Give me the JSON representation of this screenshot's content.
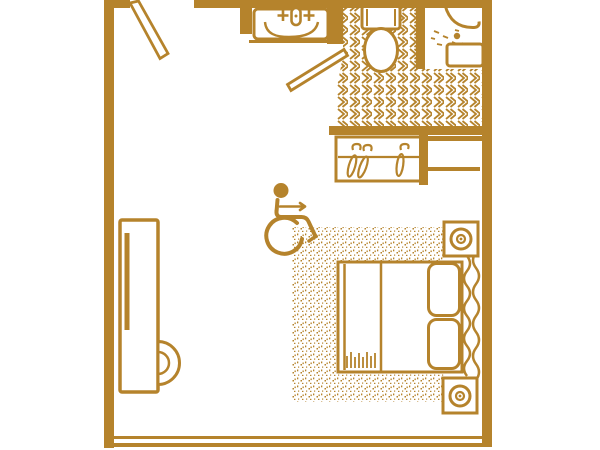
{
  "colors": {
    "ink": "#B5832C",
    "background": "#FFFFFF"
  },
  "floor_plan": {
    "kind": "accessible-hotel-room-floor-plan",
    "tile_pattern": "chevron-tiles",
    "carpet_pattern": "stipple-dots",
    "elements": [
      "entry-door",
      "vanity-sink",
      "bathroom-door",
      "toilet",
      "shower-fixture",
      "shower-seat",
      "tiled-bathroom-floor",
      "closet-rod-with-hangers",
      "storage-shelf",
      "wheelchair-accessibility-symbol",
      "carpet-area",
      "double-bed",
      "pillows",
      "headboard-waves",
      "nightstand-lamp-top",
      "nightstand-lamp-bottom",
      "tv-console",
      "side-chair"
    ]
  }
}
